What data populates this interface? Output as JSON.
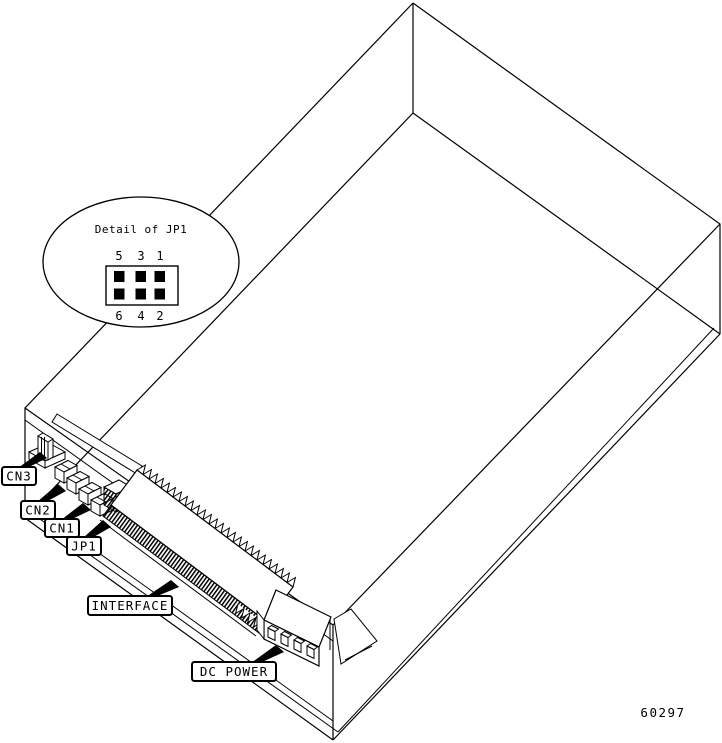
{
  "figure": {
    "callouts": {
      "cn3": "CN3",
      "cn2": "CN2",
      "cn1": "CN1",
      "jp1": "JP1",
      "interface": "INTERFACE",
      "dc_power": "DC POWER"
    },
    "detail_bubble": {
      "title": "Detail of JP1",
      "pins_top": [
        "5",
        "3",
        "1"
      ],
      "pins_bottom": [
        "6",
        "4",
        "2"
      ]
    },
    "figure_number": "60297",
    "colors": {
      "line": "#000000",
      "background": "#ffffff"
    }
  }
}
